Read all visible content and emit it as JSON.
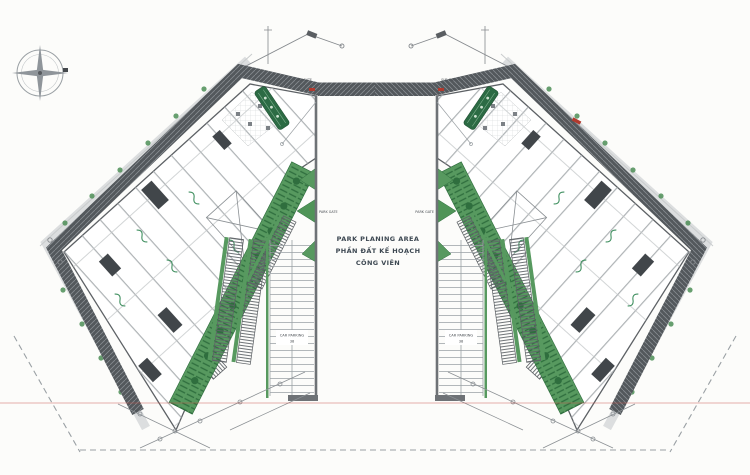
{
  "plan": {
    "center_area": {
      "line1": "PARK PLANING AREA",
      "line2": "PHẦN ĐẤT KẾ HOẠCH",
      "line3": "CÔNG VIÊN"
    },
    "gates": {
      "left_park_gate": "PARK GATE",
      "right_park_gate": "PARK GATE",
      "left_sub_gate": "SUB GATE",
      "right_sub_gate": "SUB GATE"
    },
    "parking": {
      "left": {
        "label": "CAR PARKING",
        "count": "38"
      },
      "right": {
        "label": "CAR PARKING",
        "count": "38"
      }
    },
    "colors": {
      "landscape_green": "#57995f",
      "dark_green": "#2c6b44",
      "road_hatch_gray": "#53585c",
      "wall_gray": "#6e7276",
      "line_gray": "#9aa0a4",
      "label_ink": "#3d4852",
      "accent_red": "#b23a2e",
      "paper": "#fcfcfa"
    }
  }
}
